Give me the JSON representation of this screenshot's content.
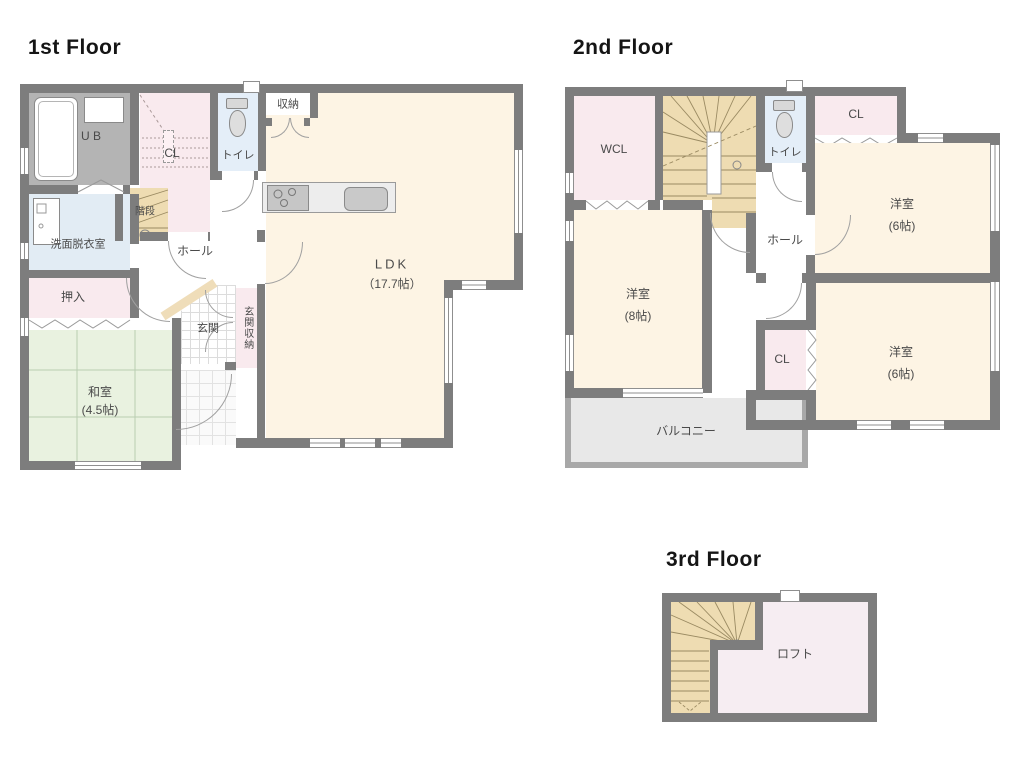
{
  "floors": {
    "f1": {
      "title": "1st Floor",
      "rooms": {
        "ub": "U B",
        "cl": "CL",
        "stairs": "階段",
        "toilet": "トイレ",
        "storage": "収納",
        "hall": "ホール",
        "washroom": "洗面脱衣室",
        "oshiire": "押入",
        "washitsu_name": "和室",
        "washitsu_size": "(4.5帖)",
        "ldk_name": "LDK",
        "ldk_size": "（17.7帖）",
        "genkan": "玄関",
        "genkan_storage": "玄関収納"
      }
    },
    "f2": {
      "title": "2nd Floor",
      "rooms": {
        "wcl": "WCL",
        "toilet": "トイレ",
        "cl_top": "CL",
        "bed_ne_name": "洋室",
        "bed_ne_size": "(6帖)",
        "hall": "ホール",
        "bed_w_name": "洋室",
        "bed_w_size": "(8帖)",
        "cl_mid": "CL",
        "bed_se_name": "洋室",
        "bed_se_size": "(6帖)",
        "balcony": "バルコニー"
      }
    },
    "f3": {
      "title": "3rd Floor",
      "rooms": {
        "loft": "ロフト"
      }
    }
  },
  "colors": {
    "wall": "#7d7d7d",
    "room_cream": "#fdf4e4",
    "room_pink": "#f9eaee",
    "room_tan": "#eedcb2",
    "room_blue": "#e4eef8",
    "room_green": "#e9f2e0",
    "ub_gray": "#b4b4b4",
    "balcony_gray": "#e8e8e8",
    "loft_pink": "#f6edf2"
  }
}
